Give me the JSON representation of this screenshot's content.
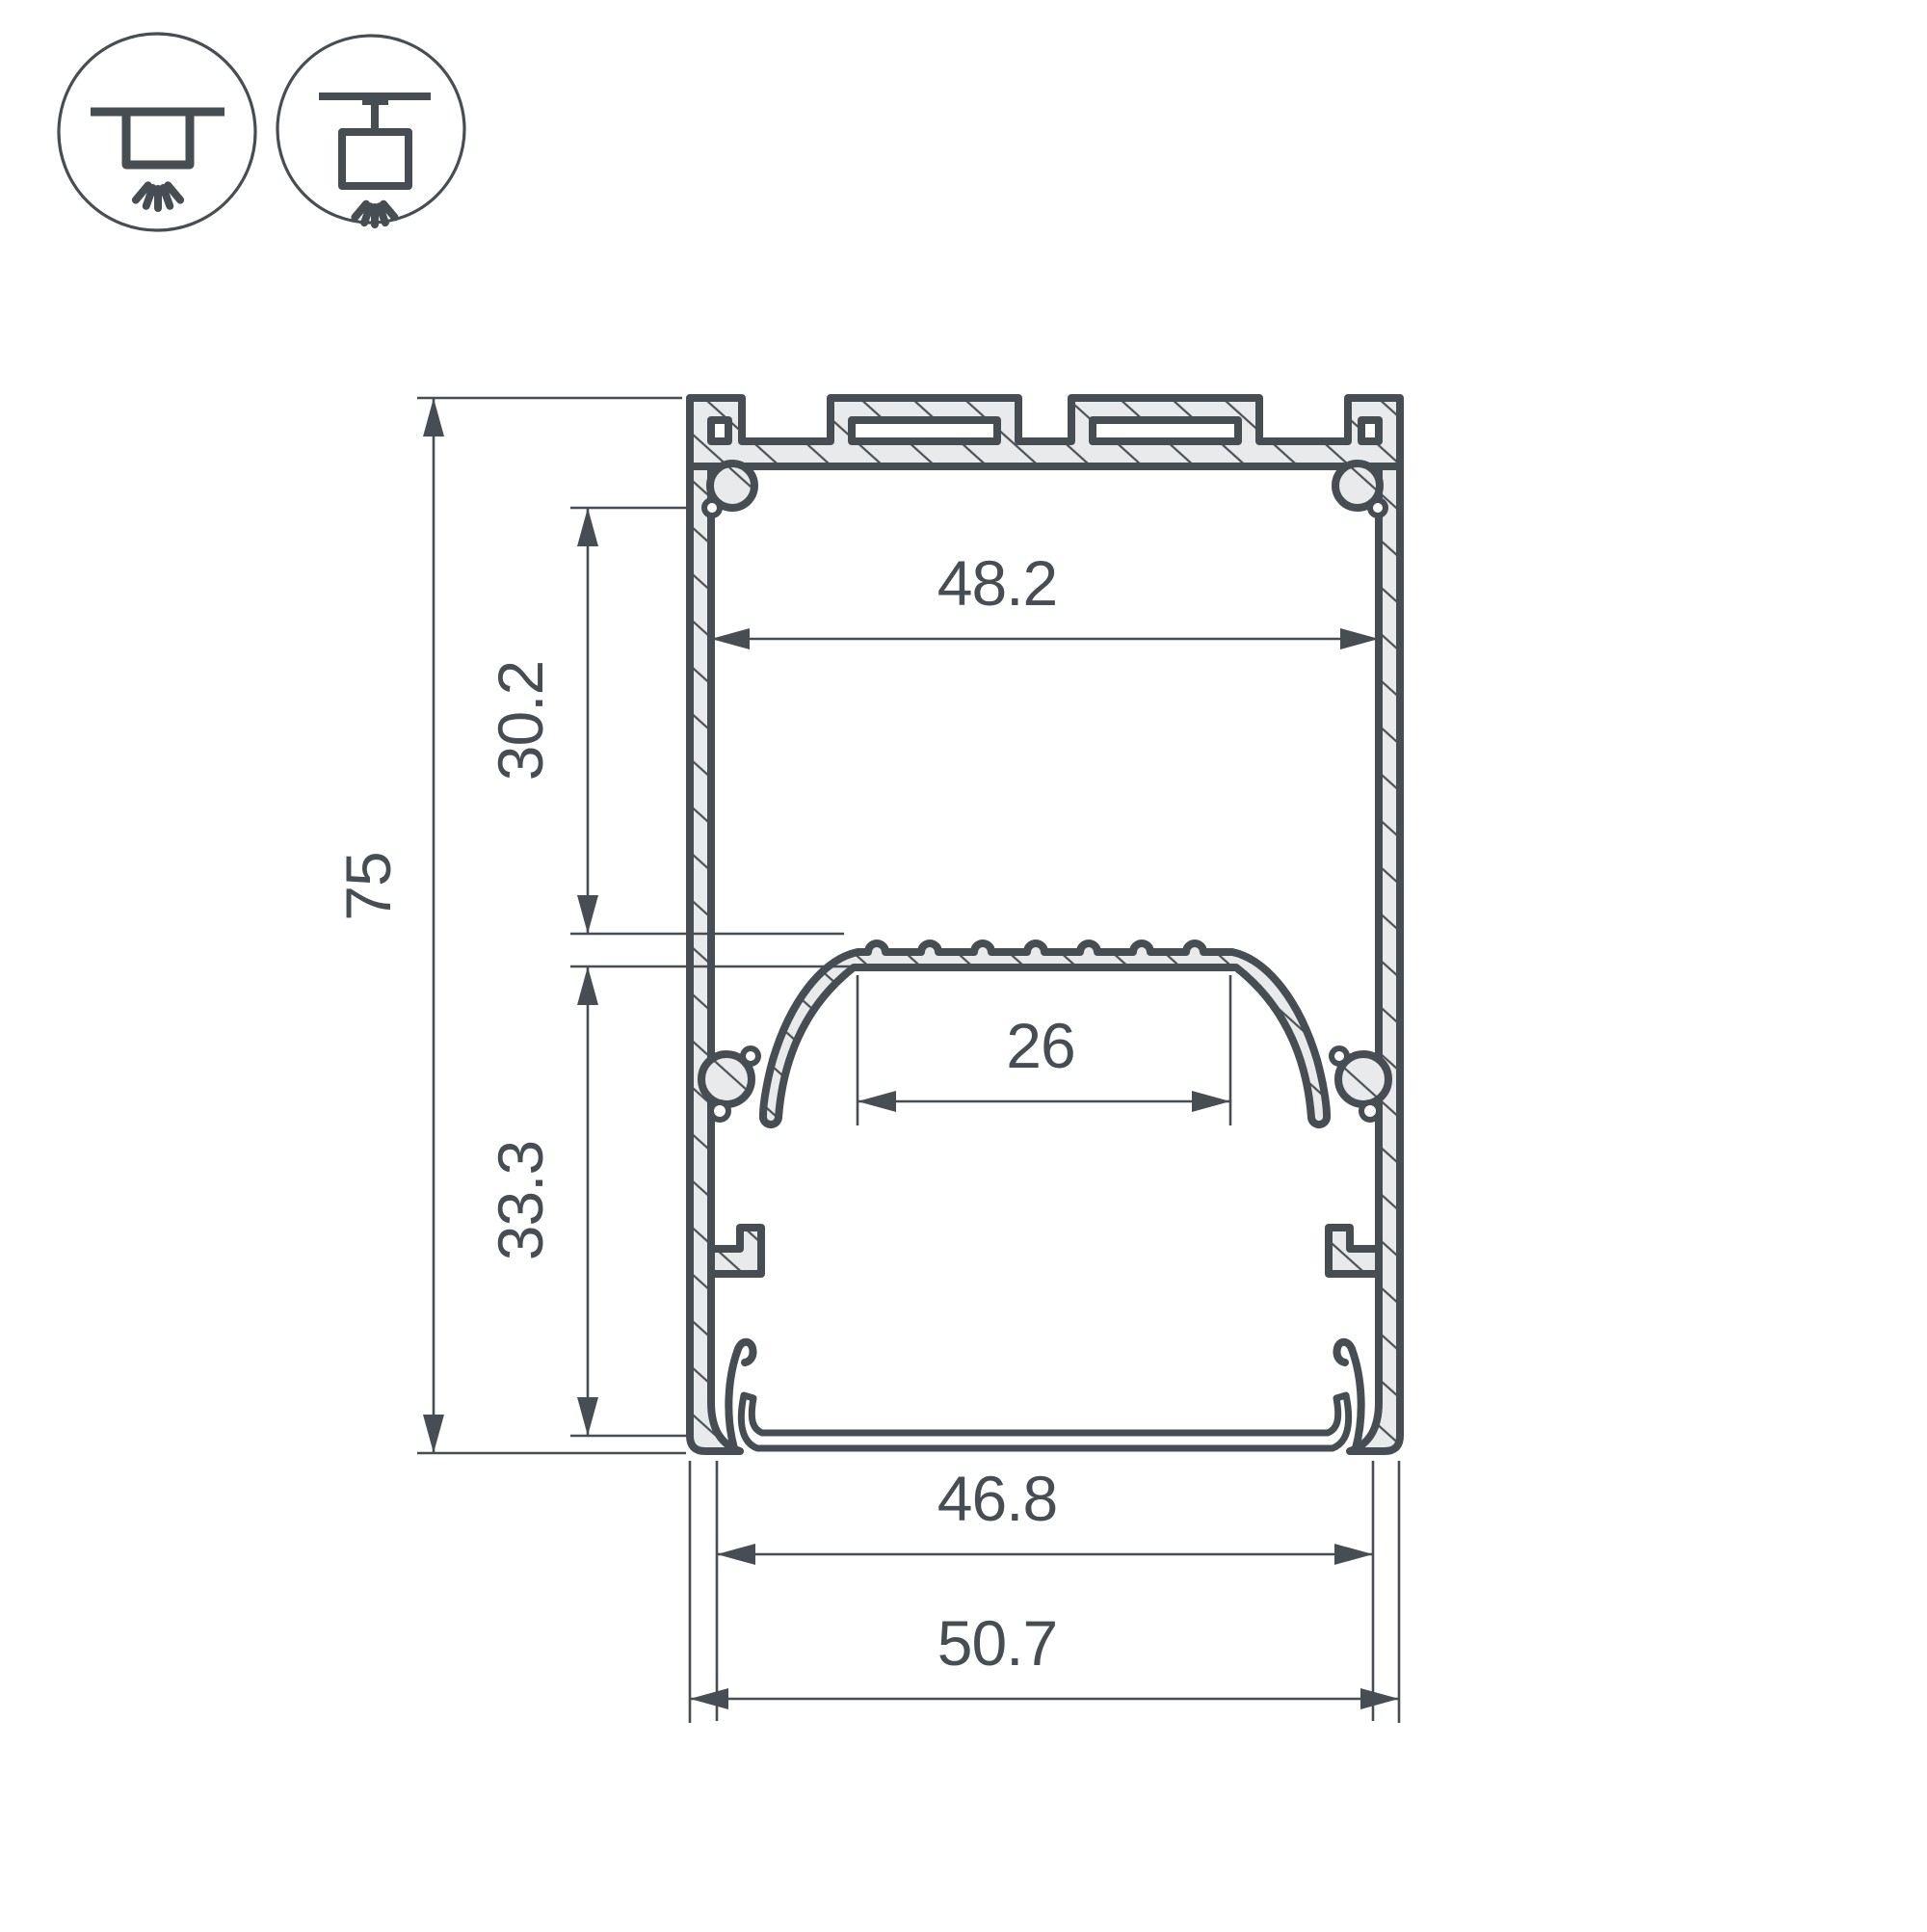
{
  "drawing": {
    "title": "LED aluminum profile cross-section technical drawing",
    "colors": {
      "line": "#474e53",
      "fill": "#e9eaeb",
      "background": "#ffffff"
    },
    "mount_icons": [
      {
        "name": "surface-ceiling-mount-icon"
      },
      {
        "name": "pendant-suspension-mount-icon"
      }
    ],
    "dimensions": {
      "overall_height": "75",
      "overall_width": "50.7",
      "top_inner_width": "48.2",
      "upper_cavity_height": "30.2",
      "lower_cavity_height": "33.3",
      "led_platform_width": "26",
      "bottom_inner_width": "46.8"
    }
  }
}
